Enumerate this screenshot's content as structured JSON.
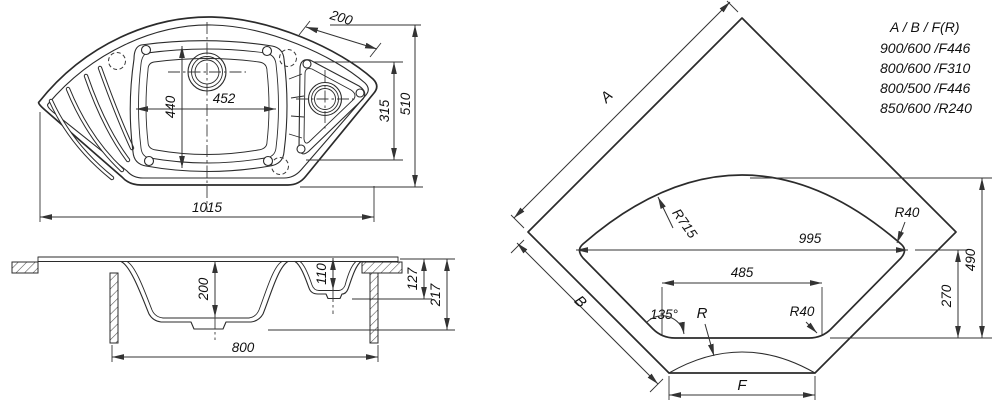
{
  "top_view": {
    "overall_width": "1015",
    "overall_depth": "510",
    "right_bowl_depth": "315",
    "corner_edge_offset": "200",
    "main_bowl_width": "452",
    "main_bowl_length": "440"
  },
  "section_view": {
    "main_bowl_depth": "200",
    "small_bowl_depth": "110",
    "rim_to_base": "127",
    "total_height": "217",
    "cabinet_width": "800"
  },
  "corner_view": {
    "side_a": "A",
    "side_b": "B",
    "front_f": "F",
    "front_radius": "R",
    "back_radius": "R715",
    "fillet_right": "R40",
    "fillet_front": "R40",
    "cutout_width": "995",
    "cutout_front_width": "485",
    "front_height": "270",
    "cutout_depth": "490",
    "corner_angle": "135°"
  },
  "size_table": {
    "header": "A / B / F(R)",
    "rows": [
      "900/600 /F446",
      "800/600 /F310",
      "800/500 /F446",
      "850/600 /R240"
    ]
  }
}
